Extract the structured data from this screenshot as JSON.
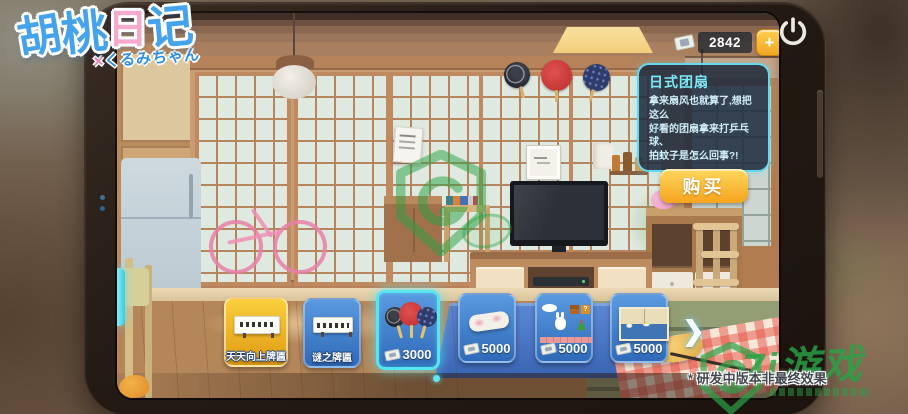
{
  "logo": {
    "title": "胡桃日记",
    "chars": [
      "胡",
      "桃",
      "日",
      "记"
    ],
    "subtitle_x": "×",
    "subtitle": "くるみちゃん"
  },
  "hud": {
    "currency_amount": "2842",
    "add_button": "+"
  },
  "tooltip": {
    "title": "日式团扇",
    "description": [
      "拿来扇风也就算了,想把这么",
      "好看的团扇拿来打乒乓球、",
      "拍蚊子是怎么回事?!"
    ],
    "buy_button": "购买"
  },
  "shop": {
    "next_arrow": "❯",
    "items": [
      {
        "label": "天天向上牌匾",
        "style": "gold",
        "image": "plaque",
        "selected": false
      },
      {
        "label": "谜之牌匾",
        "style": "blue",
        "image": "plaque",
        "selected": false
      },
      {
        "price": "3000",
        "style": "blue",
        "image": "fans",
        "selected": true
      },
      {
        "price": "5000",
        "style": "blue",
        "image": "fabric",
        "selected": false
      },
      {
        "price": "5000",
        "style": "blue",
        "image": "platformer",
        "selected": false
      },
      {
        "price": "5000",
        "style": "blue",
        "image": "wave-painting",
        "selected": false
      }
    ]
  },
  "footer": {
    "disclaimer": "* 研发中版本非最终效果"
  },
  "watermark": {
    "brand": "7i游戏"
  },
  "colors": {
    "accent_cyan": "#58e4f4",
    "buy_gold": "#f5a41d",
    "panel_border": "#66d9ee",
    "watermark_green": "#2aa246",
    "card_blue": "#2f6ab8",
    "card_gold": "#e09a12"
  }
}
